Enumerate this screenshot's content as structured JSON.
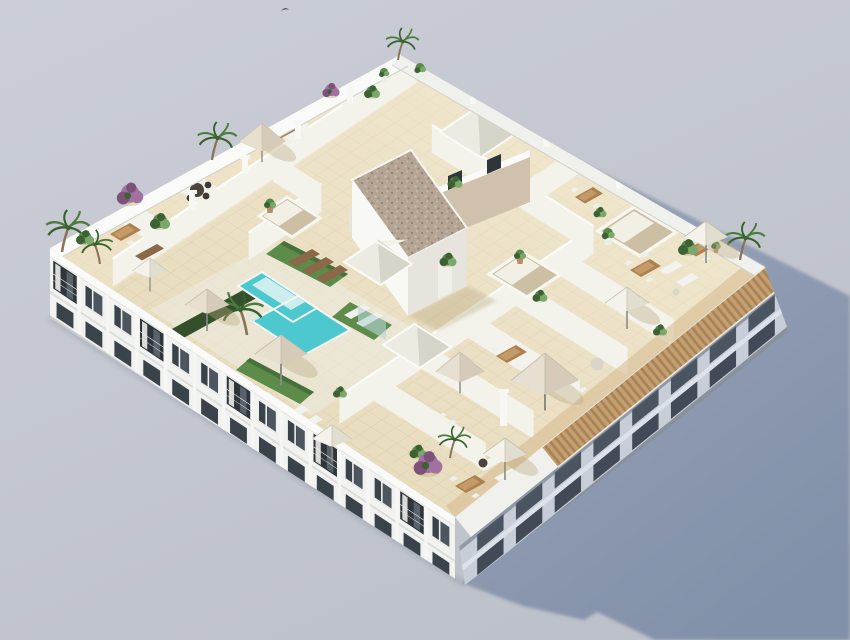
{
  "scene": {
    "description": "Aerial 3D architectural rendering of a white modern apartment building viewed from above at an angle. The flat rooftop is a landscaped terrace with beige tiled floors, a turquoise communal swimming pool with tanning shelf, artificial turf lounging areas, private terraces separated by white walls, parasols, dining sets, palm trees and shrubs, pyramid skylights, open lightwells and a central stair core with a gravel roof. The building casts a long blue-gray shadow to the right on a plain light gray ground.",
    "style": "isometric-style daytime exterior render",
    "background": "plain light gray studio backdrop",
    "shadow_direction": "cast to the right / east of the building"
  },
  "building": {
    "type": "residential apartment block",
    "floors_visible": 3,
    "facade_finish": "white render",
    "southwest_facade": {
      "bays": 14,
      "features": [
        "recessed balconies with railings and curtains",
        "dark glazed windows",
        "white floor slabs"
      ]
    },
    "southeast_facade": {
      "bays": 8,
      "features": [
        "wooden slat pergola along roof edge",
        "shaded balconies",
        "columns"
      ]
    }
  },
  "rooftop": {
    "flooring": "beige ceramic tile grid",
    "amenities": [
      "communal swimming pool",
      "tanning shelf",
      "pool-side artificial turf",
      "dark green hedge",
      "private terraces with parasols",
      "outdoor dining sets",
      "sun loungers",
      "outdoor sofas",
      "pyramid skylights",
      "open lightwells",
      "stair core with gravel roof",
      "wooden pergola edge",
      "palm trees",
      "flowering purple shrubs"
    ],
    "counts": {
      "parasols": 8,
      "canvas_tents": 2,
      "skylight_pyramids": 3,
      "lightwells": 3,
      "palm_trees": 7,
      "dining_sets": 7,
      "sun_loungers": 7,
      "sofas": 6,
      "terrace_dividing_walls": 14,
      "purple_shrubs": 3
    }
  },
  "wildlife": {
    "birds_in_sky": 1
  },
  "colors": {
    "bg_top": "#cbced6",
    "bg_bottom": "#bdc1c9",
    "shadow_light": "#9aa5ba",
    "shadow_deep": "#8290a9",
    "facade": "#f2f3f1",
    "parapet_bright": "#fafbf8",
    "parapet_soft": "#f0f1ec",
    "glass": "#3a424a",
    "glass_deep": "#2e353b",
    "frame": "#eef0ee",
    "slab": "#f2f3f1",
    "slab_shadow": "#d3d6d4",
    "facade_base": "#c9cccb",
    "se_facade": "#c7ced8",
    "se_opening": "#4b5561",
    "se_slab": "#dee3ea",
    "pergola_wood": "#c59f6f",
    "pergola_gap": "#8a6a42",
    "tile": "#e8dcbe",
    "tile_line": "#b9a87c",
    "tile_light": "#f6efda",
    "deck": "#ecece3",
    "white_block": "#f4f5f1",
    "wall_face": "#f3f3ec",
    "wall_top": "#fcfcf9",
    "pillar": "#f7f8f3",
    "pool": "#4cc8ce",
    "pool_shelf": "#cdeeee",
    "pool_rim": "#f4f6f2",
    "turf": "#5d8c4a",
    "turf_dark": "#46713a",
    "hedge": "#344f2c",
    "gravel": "#b4a493",
    "gravel_dot_dark": "#93836f",
    "gravel_dot_light": "#c8baa9",
    "core_white": "#f8f8f4",
    "core_shade": "#e6e4dc",
    "core_tan": "#cfc1ab",
    "wood_deck": "#d9bc92",
    "table_wood": "#ab8152",
    "table_top": "#c49a66",
    "chair": "#eef0ea",
    "sofa": "#f2f2ee",
    "dark_table": "#4a443c",
    "lounger_brown": "#8a6848",
    "lounger_white": "#f1f1ec",
    "parasol_nw": "#e9e6da",
    "parasol_ne": "#d6d2c2",
    "parasol_sw": "#f4f2ea",
    "parasol_se": "#e1ddcf",
    "tan_nw": "#ded5c4",
    "tan_ne": "#c9bfac",
    "tan_sw": "#e7dfcf",
    "tan_se": "#d5cbb8",
    "parasol_rib": "#c6c2b2",
    "pole": "#8b8b86",
    "trunk": "#8a7355",
    "palm": "#4a7c3f",
    "palm_dark": "#36602e",
    "leaf": "#56884a",
    "leaf_dark": "#3c6132",
    "leaf_light": "#7aa868",
    "purple": "#a371a0",
    "purple_dark": "#7c5279",
    "pot": "#b98d6a",
    "pot_white": "#eceee9",
    "item_shadow": "#b8a77d",
    "glass_fence": "#b8d4d6",
    "contact_shadow": "#7d889e",
    "bird": "#4e5864"
  }
}
